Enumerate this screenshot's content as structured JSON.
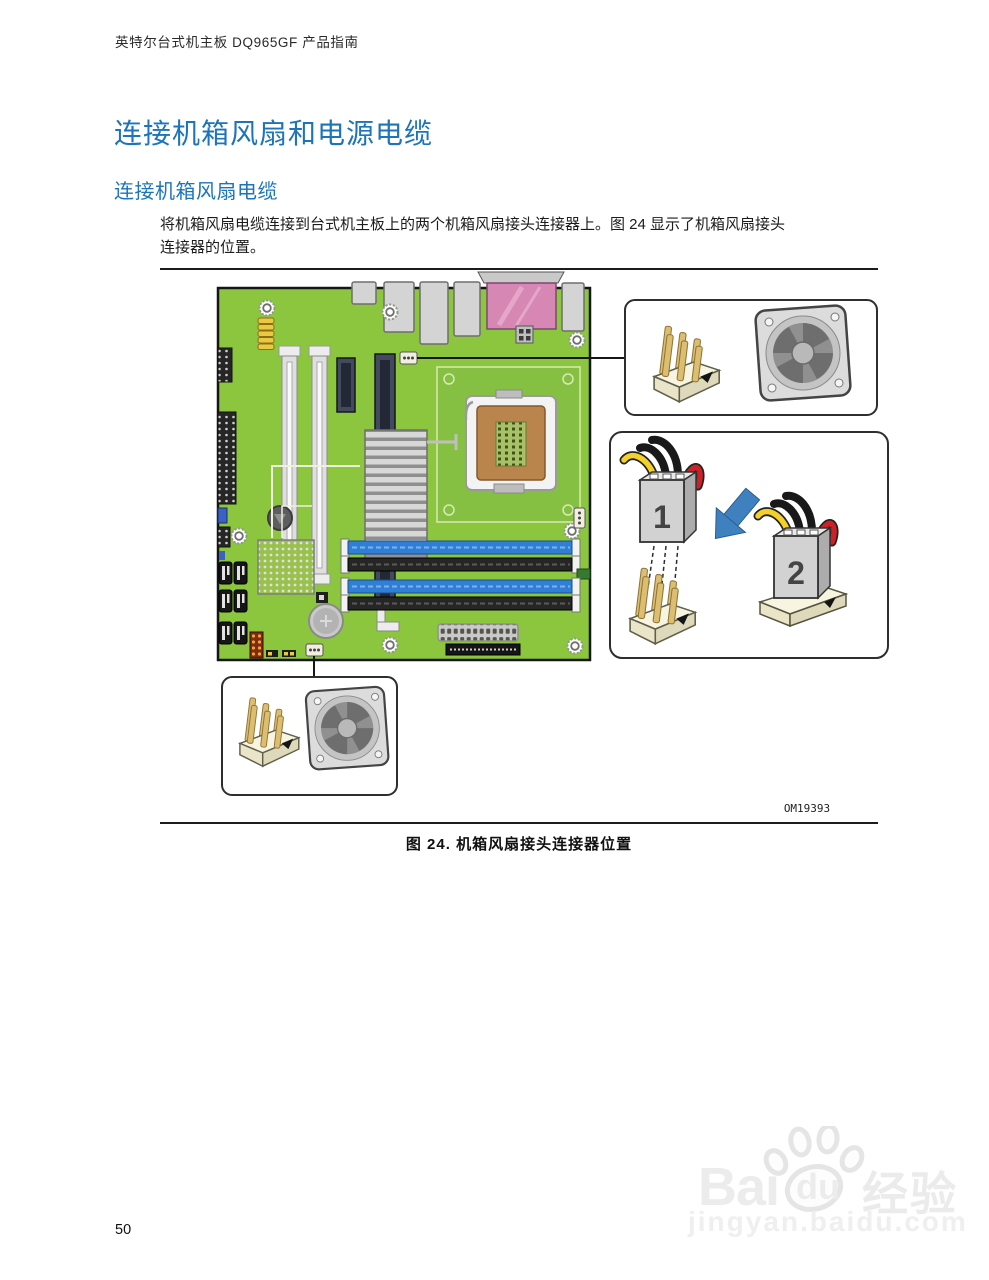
{
  "colors": {
    "heading_blue": "#1B74BC",
    "pcb_green": "#8CC63F",
    "dimm_blue": "#2F7FD6",
    "port_pink": "#D687B4",
    "wire_yellow": "#F3D02A",
    "wire_red": "#CC2127",
    "arrow_blue": "#3F80BF"
  },
  "header": {
    "title": "英特尔台式机主板 DQ965GF 产品指南"
  },
  "content": {
    "h1": "连接机箱风扇和电源电缆",
    "h2": "连接机箱风扇电缆",
    "body_lines": [
      "将机箱风扇电缆连接到台式机主板上的两个机箱风扇接头连接器上。图 24 显示了机箱风扇接头",
      "连接器的位置。"
    ]
  },
  "figure": {
    "code": "OM19393",
    "caption": "图 24. 机箱风扇接头连接器位置",
    "plug1_label": "1",
    "plug2_label": "2"
  },
  "footer": {
    "page_number": "50"
  },
  "watermark": {
    "brand_left": "Bai",
    "brand_right": "du",
    "brand_cn": "经验",
    "url": "jingyan.baidu.com"
  }
}
